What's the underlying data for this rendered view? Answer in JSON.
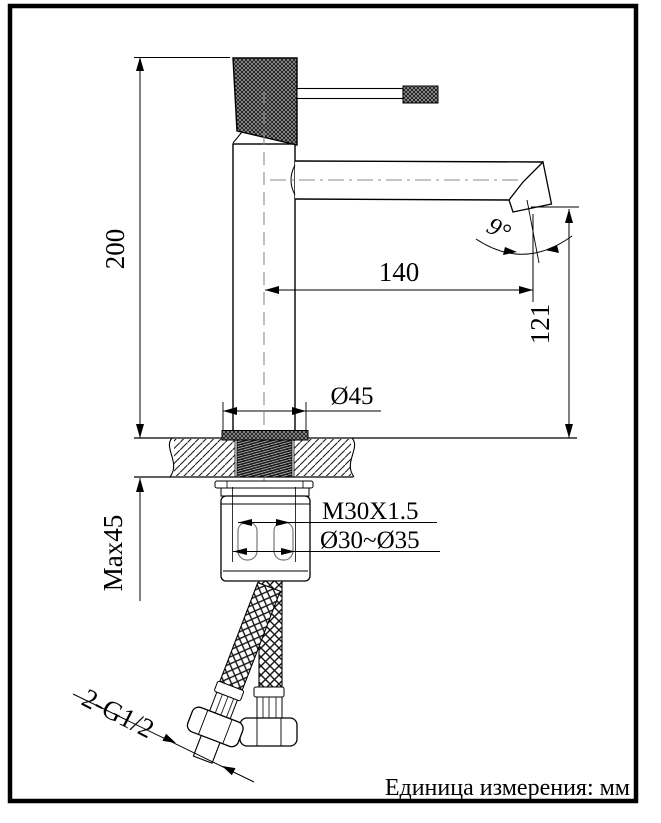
{
  "page": {
    "background": "#ffffff",
    "line_color": "#000000",
    "centerline_color": "#8a8a8a"
  },
  "drawing": {
    "unit_note": "Единица измерения: мм",
    "dimensions": {
      "overall_height": "200",
      "spout_reach": "140",
      "spout_outlet_height": "121",
      "outlet_angle": "9°",
      "base_diameter": "Ø45",
      "shank_thread": "M30X1.5",
      "mounting_hole_range": "Ø30~Ø35",
      "max_counter_thickness": "Max45",
      "supply_hose_thread": "2-G1/2"
    }
  }
}
